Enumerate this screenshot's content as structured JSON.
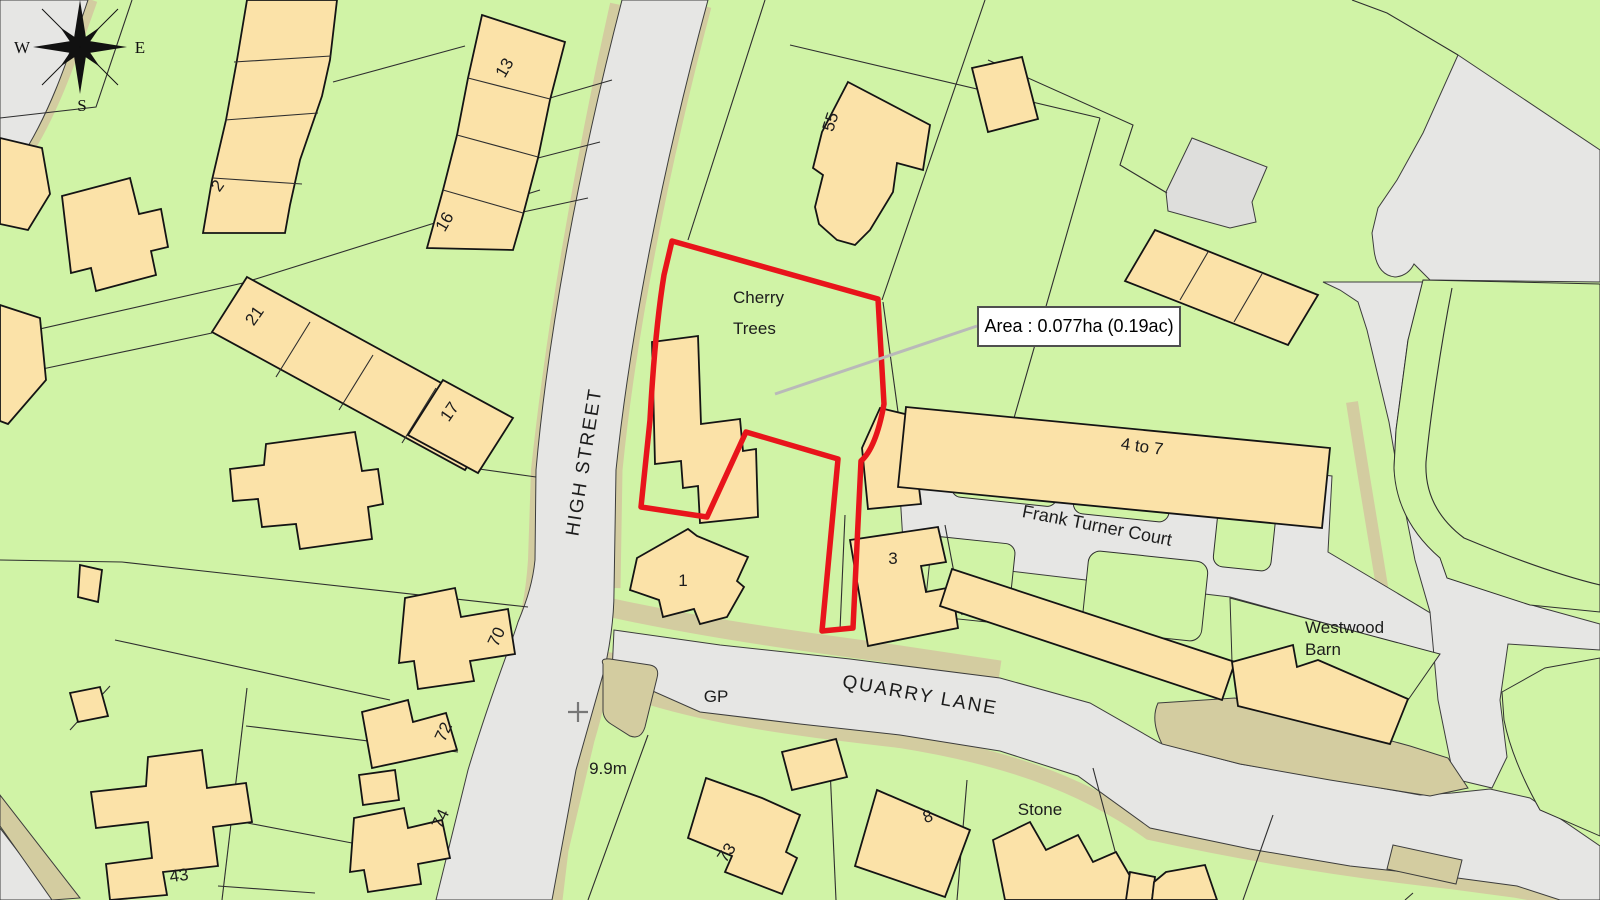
{
  "map": {
    "title_labels": {
      "cherry_line1": "Cherry",
      "cherry_line2": "Trees",
      "high_street": "HIGH STREET",
      "quarry_lane": "QUARRY LANE",
      "frank_turner_court": "Frank Turner Court",
      "four_to_seven": "4 to 7",
      "westwood_line1": "Westwood",
      "westwood_line2": "Barn",
      "stone": "Stone",
      "gp": "GP",
      "spot_height": "9.9m"
    },
    "area_callout": {
      "text": "Area : 0.077ha (0.19ac)"
    },
    "compass": {
      "w": "W",
      "e": "E",
      "s": "S"
    },
    "house_numbers": {
      "n1": "1",
      "n2": "2",
      "n3": "3",
      "n8": "8",
      "n13": "13",
      "n16": "16",
      "n17": "17",
      "n21": "21",
      "n43": "43",
      "n55": "55",
      "n70": "70",
      "n72": "72",
      "n73": "73",
      "n74": "74"
    },
    "palette": {
      "parcel_green": "#d0f3a6",
      "building_tan": "#fbe2a8",
      "road_gray": "#e6e6e4",
      "verge_khaki": "#d3cca0",
      "site_boundary_red": "#e8141b"
    }
  }
}
